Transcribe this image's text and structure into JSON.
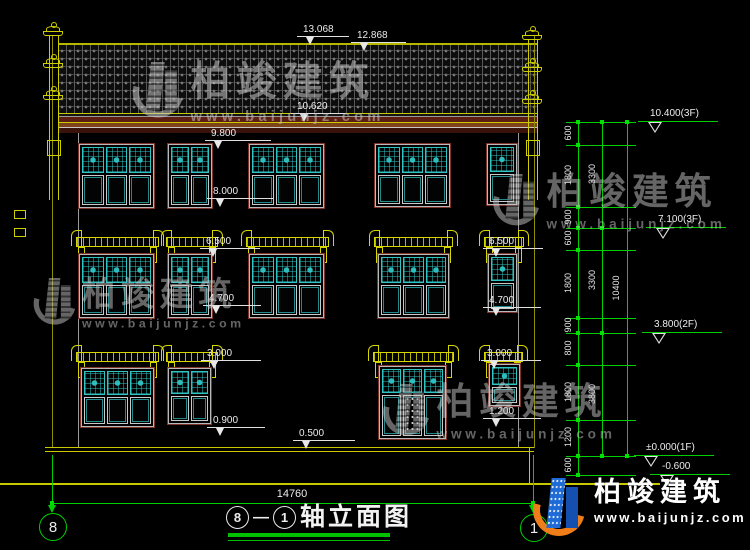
{
  "title": {
    "text": "轴立面图",
    "dash": "—"
  },
  "axis": {
    "left": "8",
    "right": "1"
  },
  "overall_dim": "14760",
  "colors": {
    "background": "#000000",
    "cad_yellow": "#d6d600",
    "cad_green": "#00d000",
    "lattice_teal": "#2fc4c4",
    "frame_maroon": "#7e332a",
    "dim_white": "#ececec",
    "logo_blue": "#1e6bd6",
    "logo_orange": "#ef7d1a"
  },
  "dims": [
    {
      "label": "13.068",
      "x": 303,
      "y": 24,
      "lw": 52
    },
    {
      "label": "12.868",
      "x": 357,
      "y": 30,
      "lw": 55
    },
    {
      "label": "10.620",
      "x": 297,
      "y": 101,
      "lw": 55
    },
    {
      "label": "9.800",
      "x": 211,
      "y": 128,
      "lw": 66
    },
    {
      "label": "8.000",
      "x": 213,
      "y": 186,
      "lw": 66
    },
    {
      "label": "6.500",
      "x": 206,
      "y": 236,
      "lw": 60
    },
    {
      "label": "6.500",
      "x": 489,
      "y": 236,
      "lw": 60
    },
    {
      "label": "4.700",
      "x": 209,
      "y": 293,
      "lw": 58
    },
    {
      "label": "4.700",
      "x": 489,
      "y": 295,
      "lw": 58
    },
    {
      "label": "3.000",
      "x": 207,
      "y": 348,
      "lw": 60
    },
    {
      "label": "3.000",
      "x": 487,
      "y": 348,
      "lw": 60
    },
    {
      "label": "0.900",
      "x": 213,
      "y": 415,
      "lw": 58
    },
    {
      "label": "1.200",
      "x": 489,
      "y": 406,
      "lw": 58
    },
    {
      "label": "0.500",
      "x": 299,
      "y": 428,
      "lw": 62
    }
  ],
  "elevation_markers": [
    {
      "label": "10.400(3F)",
      "x": 650,
      "line_y": 122
    },
    {
      "label": "7.100(3F)",
      "x": 658,
      "line_y": 228
    },
    {
      "label": "3.800(2F)",
      "x": 654,
      "line_y": 333
    },
    {
      "label": "±0.000(1F)",
      "x": 646,
      "line_y": 456
    },
    {
      "label": "-0.600",
      "x": 662,
      "line_y": 475
    }
  ],
  "right_chain": {
    "ext_x1": 566,
    "ext_x2": 636,
    "levels": [
      122,
      145,
      207,
      228,
      250,
      318,
      333,
      365,
      420,
      456,
      475
    ],
    "columns": [
      {
        "x": 578,
        "lx": 568,
        "segments": [
          {
            "label": "600",
            "y1": 122,
            "y2": 145
          },
          {
            "label": "1800",
            "y1": 145,
            "y2": 207
          },
          {
            "label": "900",
            "y1": 207,
            "y2": 228
          },
          {
            "label": "600",
            "y1": 228,
            "y2": 250
          },
          {
            "label": "1800",
            "y1": 250,
            "y2": 318
          },
          {
            "label": "900",
            "y1": 318,
            "y2": 333
          },
          {
            "label": "800",
            "y1": 333,
            "y2": 365
          },
          {
            "label": "1800",
            "y1": 365,
            "y2": 420
          },
          {
            "label": "1200",
            "y1": 420,
            "y2": 456
          },
          {
            "label": "600",
            "y1": 456,
            "y2": 475
          }
        ]
      },
      {
        "x": 602,
        "lx": 592,
        "segments": [
          {
            "label": "3300",
            "y1": 122,
            "y2": 228
          },
          {
            "label": "3300",
            "y1": 228,
            "y2": 333
          },
          {
            "label": "3800",
            "y1": 333,
            "y2": 456
          }
        ]
      },
      {
        "x": 627,
        "lx": 616,
        "segments": [
          {
            "label": "10400",
            "y1": 122,
            "y2": 456
          }
        ]
      }
    ]
  },
  "windows": [
    {
      "kind": "w3",
      "x": 78,
      "y": 143,
      "w": 77,
      "h": 66
    },
    {
      "kind": "w2",
      "x": 167,
      "y": 143,
      "w": 46,
      "h": 66
    },
    {
      "kind": "w3",
      "x": 248,
      "y": 143,
      "w": 77,
      "h": 66
    },
    {
      "kind": "w3",
      "x": 374,
      "y": 143,
      "w": 77,
      "h": 65
    },
    {
      "kind": "w1",
      "x": 486,
      "y": 143,
      "w": 32,
      "h": 63
    },
    {
      "kind": "w3",
      "x": 78,
      "y": 253,
      "w": 77,
      "h": 66
    },
    {
      "kind": "w2",
      "x": 167,
      "y": 253,
      "w": 46,
      "h": 66
    },
    {
      "kind": "w3",
      "x": 248,
      "y": 253,
      "w": 77,
      "h": 66
    },
    {
      "kind": "w3",
      "x": 377,
      "y": 253,
      "w": 73,
      "h": 66
    },
    {
      "kind": "w1",
      "x": 487,
      "y": 253,
      "w": 31,
      "h": 60
    },
    {
      "kind": "w3",
      "x": 80,
      "y": 367,
      "w": 75,
      "h": 61
    },
    {
      "kind": "w2",
      "x": 167,
      "y": 367,
      "w": 45,
      "h": 58
    },
    {
      "kind": "door",
      "x": 378,
      "y": 365,
      "w": 69,
      "h": 75
    },
    {
      "kind": "w1",
      "x": 488,
      "y": 363,
      "w": 33,
      "h": 44
    }
  ],
  "awnings": [
    {
      "x": 71,
      "y": 230,
      "w": 93
    },
    {
      "x": 161,
      "y": 230,
      "w": 62
    },
    {
      "x": 241,
      "y": 230,
      "w": 93
    },
    {
      "x": 369,
      "y": 230,
      "w": 89
    },
    {
      "x": 479,
      "y": 230,
      "w": 50
    },
    {
      "x": 71,
      "y": 345,
      "w": 93
    },
    {
      "x": 161,
      "y": 345,
      "w": 62
    },
    {
      "x": 368,
      "y": 345,
      "w": 91
    },
    {
      "x": 479,
      "y": 345,
      "w": 49
    }
  ],
  "poles": [
    {
      "cx": 53,
      "top": 36,
      "bottom": 200,
      "finial_ys": [
        22,
        54,
        86
      ]
    },
    {
      "cx": 532,
      "top": 40,
      "bottom": 200,
      "finial_ys": [
        26,
        58,
        90
      ]
    }
  ],
  "wall_marks": [
    {
      "x": 14,
      "y": 210
    },
    {
      "x": 14,
      "y": 228
    }
  ],
  "watermarks": {
    "brand": "柏竣建筑",
    "url": "www.baijunjz.com",
    "instances": [
      {
        "x": 138,
        "y": 62,
        "scale": 1.05,
        "opacity": 0.55
      },
      {
        "x": 498,
        "y": 174,
        "scale": 0.97,
        "opacity": 0.5
      },
      {
        "x": 38,
        "y": 278,
        "scale": 0.88,
        "opacity": 0.5
      },
      {
        "x": 388,
        "y": 384,
        "scale": 0.97,
        "opacity": 0.5
      }
    ]
  },
  "logo": {
    "brand": "柏竣建筑",
    "url": "www.baijunjz.com"
  }
}
